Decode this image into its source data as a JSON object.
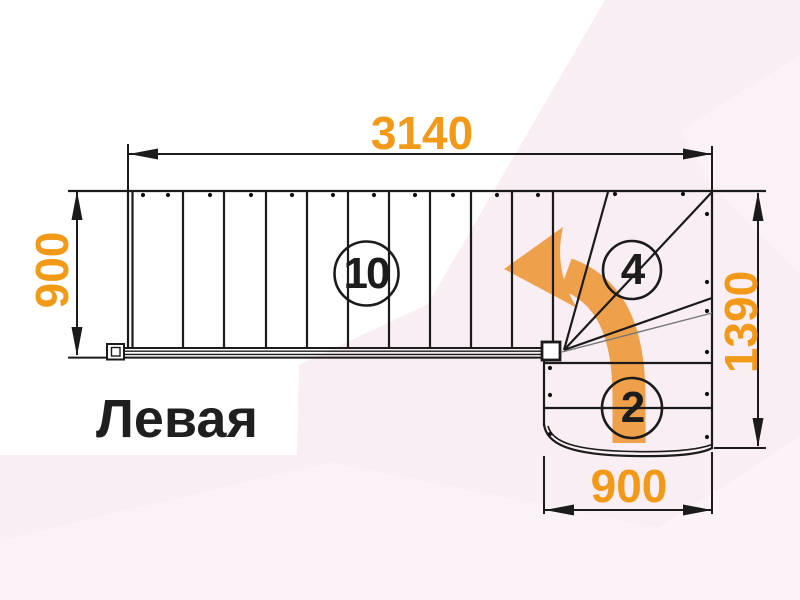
{
  "drawing": {
    "title": "Левая",
    "dimensions": {
      "total_run": "3140",
      "upper_flight_width": "900",
      "turn_height": "1390",
      "lower_flight_width": "900"
    },
    "step_counts": {
      "upper_flight": "10",
      "winders": "4",
      "lower_flight": "2"
    },
    "colors": {
      "dimension_text": "#f29a18",
      "direction_arrow": "#efa04a",
      "drawing_line": "#1b1b1b",
      "background_tint": "#f8eef4"
    }
  }
}
